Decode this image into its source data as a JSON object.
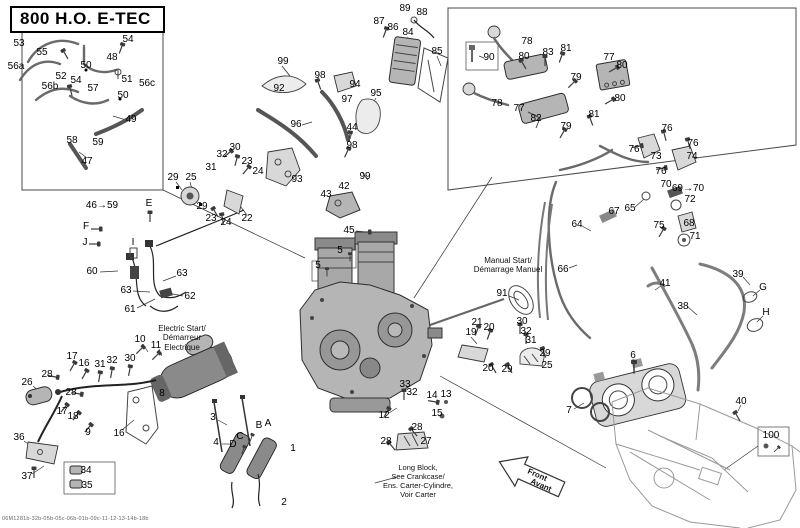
{
  "title": "800 H.O. E-TEC",
  "footer_code": "06M1281b-32b-05b-05c-06b-01b-09c-11-12-13-14b-18b",
  "annotations": {
    "electric_start": [
      "Electric Start/",
      "Démarreur",
      "Electrique"
    ],
    "manual_start": [
      "Manual Start/",
      "Démarrage Manuel"
    ],
    "long_block": [
      "Long Block,",
      "See Crankcase/",
      "Ens. Carter-Cylindre,",
      "Voir Carter"
    ],
    "front_arrow": [
      "Front",
      "Avant"
    ]
  },
  "callouts": [
    {
      "t": "53",
      "x": 19,
      "y": 44
    },
    {
      "t": "54",
      "x": 128,
      "y": 40
    },
    {
      "t": "55",
      "x": 42,
      "y": 53
    },
    {
      "t": "56a",
      "x": 16,
      "y": 67
    },
    {
      "t": "48",
      "x": 112,
      "y": 58
    },
    {
      "t": "50",
      "x": 86,
      "y": 66
    },
    {
      "t": "52",
      "x": 61,
      "y": 77
    },
    {
      "t": "54",
      "x": 76,
      "y": 81
    },
    {
      "t": "56b",
      "x": 50,
      "y": 87
    },
    {
      "t": "51",
      "x": 127,
      "y": 80
    },
    {
      "t": "56c",
      "x": 147,
      "y": 84
    },
    {
      "t": "57",
      "x": 93,
      "y": 89
    },
    {
      "t": "50",
      "x": 123,
      "y": 96
    },
    {
      "t": "49",
      "x": 131,
      "y": 120
    },
    {
      "t": "58",
      "x": 72,
      "y": 141
    },
    {
      "t": "59",
      "x": 98,
      "y": 143
    },
    {
      "t": "47",
      "x": 87,
      "y": 162
    },
    {
      "t": "29",
      "x": 173,
      "y": 178
    },
    {
      "t": "25",
      "x": 191,
      "y": 178
    },
    {
      "t": "46→59",
      "x": 102,
      "y": 206
    },
    {
      "t": "E",
      "x": 149,
      "y": 204
    },
    {
      "t": "F",
      "x": 86,
      "y": 227
    },
    {
      "t": "J",
      "x": 85,
      "y": 243
    },
    {
      "t": "I",
      "x": 133,
      "y": 243
    },
    {
      "t": "60",
      "x": 92,
      "y": 272
    },
    {
      "t": "63",
      "x": 182,
      "y": 274
    },
    {
      "t": "63",
      "x": 126,
      "y": 291
    },
    {
      "t": "62",
      "x": 190,
      "y": 297
    },
    {
      "t": "61",
      "x": 130,
      "y": 310
    },
    {
      "t": "30",
      "x": 235,
      "y": 148
    },
    {
      "t": "32",
      "x": 222,
      "y": 155
    },
    {
      "t": "23",
      "x": 247,
      "y": 162
    },
    {
      "t": "31",
      "x": 211,
      "y": 168
    },
    {
      "t": "24",
      "x": 258,
      "y": 172
    },
    {
      "t": "29",
      "x": 202,
      "y": 207
    },
    {
      "t": "23",
      "x": 211,
      "y": 219
    },
    {
      "t": "24",
      "x": 226,
      "y": 223
    },
    {
      "t": "22",
      "x": 247,
      "y": 219
    },
    {
      "t": "99",
      "x": 283,
      "y": 62
    },
    {
      "t": "92",
      "x": 279,
      "y": 89
    },
    {
      "t": "98",
      "x": 320,
      "y": 76
    },
    {
      "t": "94",
      "x": 355,
      "y": 85
    },
    {
      "t": "97",
      "x": 347,
      "y": 100
    },
    {
      "t": "95",
      "x": 376,
      "y": 94
    },
    {
      "t": "96",
      "x": 296,
      "y": 125
    },
    {
      "t": "44",
      "x": 352,
      "y": 128
    },
    {
      "t": "98",
      "x": 352,
      "y": 146
    },
    {
      "t": "99",
      "x": 365,
      "y": 177
    },
    {
      "t": "93",
      "x": 297,
      "y": 180
    },
    {
      "t": "42",
      "x": 344,
      "y": 187
    },
    {
      "t": "43",
      "x": 326,
      "y": 195
    },
    {
      "t": "45",
      "x": 349,
      "y": 231
    },
    {
      "t": "89",
      "x": 405,
      "y": 9
    },
    {
      "t": "88",
      "x": 422,
      "y": 13
    },
    {
      "t": "87",
      "x": 379,
      "y": 22
    },
    {
      "t": "86",
      "x": 393,
      "y": 28
    },
    {
      "t": "84",
      "x": 408,
      "y": 33
    },
    {
      "t": "85",
      "x": 437,
      "y": 52
    },
    {
      "t": "78",
      "x": 527,
      "y": 42
    },
    {
      "t": "90",
      "x": 489,
      "y": 58
    },
    {
      "t": "80",
      "x": 524,
      "y": 57
    },
    {
      "t": "83",
      "x": 548,
      "y": 53
    },
    {
      "t": "81",
      "x": 566,
      "y": 49
    },
    {
      "t": "77",
      "x": 609,
      "y": 58
    },
    {
      "t": "80",
      "x": 622,
      "y": 66
    },
    {
      "t": "79",
      "x": 576,
      "y": 78
    },
    {
      "t": "80",
      "x": 620,
      "y": 99
    },
    {
      "t": "78",
      "x": 497,
      "y": 104
    },
    {
      "t": "77",
      "x": 519,
      "y": 109
    },
    {
      "t": "82",
      "x": 536,
      "y": 119
    },
    {
      "t": "81",
      "x": 594,
      "y": 115
    },
    {
      "t": "79",
      "x": 566,
      "y": 127
    },
    {
      "t": "76",
      "x": 667,
      "y": 129
    },
    {
      "t": "76",
      "x": 634,
      "y": 150
    },
    {
      "t": "73",
      "x": 656,
      "y": 157
    },
    {
      "t": "76",
      "x": 693,
      "y": 144
    },
    {
      "t": "74",
      "x": 692,
      "y": 157
    },
    {
      "t": "76",
      "x": 661,
      "y": 172
    },
    {
      "t": "70",
      "x": 666,
      "y": 185
    },
    {
      "t": "69→70",
      "x": 688,
      "y": 189
    },
    {
      "t": "72",
      "x": 690,
      "y": 200
    },
    {
      "t": "65",
      "x": 630,
      "y": 209
    },
    {
      "t": "67",
      "x": 614,
      "y": 212
    },
    {
      "t": "64",
      "x": 577,
      "y": 225
    },
    {
      "t": "75",
      "x": 659,
      "y": 226
    },
    {
      "t": "68",
      "x": 689,
      "y": 224
    },
    {
      "t": "71",
      "x": 695,
      "y": 237
    },
    {
      "t": "66",
      "x": 563,
      "y": 270
    },
    {
      "t": "41",
      "x": 665,
      "y": 284
    },
    {
      "t": "38",
      "x": 683,
      "y": 307
    },
    {
      "t": "39",
      "x": 738,
      "y": 275
    },
    {
      "t": "G",
      "x": 763,
      "y": 288
    },
    {
      "t": "H",
      "x": 766,
      "y": 313
    },
    {
      "t": "6",
      "x": 633,
      "y": 356
    },
    {
      "t": "7",
      "x": 569,
      "y": 411
    },
    {
      "t": "40",
      "x": 741,
      "y": 402
    },
    {
      "t": "100",
      "x": 771,
      "y": 436
    },
    {
      "t": "91",
      "x": 502,
      "y": 294
    },
    {
      "t": "21",
      "x": 477,
      "y": 323
    },
    {
      "t": "20",
      "x": 489,
      "y": 328
    },
    {
      "t": "19",
      "x": 471,
      "y": 333
    },
    {
      "t": "30",
      "x": 522,
      "y": 322
    },
    {
      "t": "32",
      "x": 526,
      "y": 332
    },
    {
      "t": "31",
      "x": 531,
      "y": 341
    },
    {
      "t": "29",
      "x": 545,
      "y": 354
    },
    {
      "t": "20",
      "x": 488,
      "y": 369
    },
    {
      "t": "29",
      "x": 507,
      "y": 370
    },
    {
      "t": "25",
      "x": 547,
      "y": 366
    },
    {
      "t": "33",
      "x": 405,
      "y": 385
    },
    {
      "t": "32",
      "x": 412,
      "y": 393
    },
    {
      "t": "14",
      "x": 432,
      "y": 396
    },
    {
      "t": "13",
      "x": 446,
      "y": 395
    },
    {
      "t": "12",
      "x": 384,
      "y": 416
    },
    {
      "t": "15",
      "x": 437,
      "y": 414
    },
    {
      "t": "28",
      "x": 417,
      "y": 428
    },
    {
      "t": "28",
      "x": 386,
      "y": 442
    },
    {
      "t": "27",
      "x": 426,
      "y": 442
    },
    {
      "t": "5",
      "x": 340,
      "y": 251
    },
    {
      "t": "5",
      "x": 318,
      "y": 266
    },
    {
      "t": "10",
      "x": 140,
      "y": 340
    },
    {
      "t": "11",
      "x": 156,
      "y": 346
    },
    {
      "t": "17",
      "x": 72,
      "y": 357
    },
    {
      "t": "16",
      "x": 84,
      "y": 364
    },
    {
      "t": "31",
      "x": 100,
      "y": 365
    },
    {
      "t": "32",
      "x": 112,
      "y": 361
    },
    {
      "t": "30",
      "x": 130,
      "y": 359
    },
    {
      "t": "28",
      "x": 47,
      "y": 375
    },
    {
      "t": "26",
      "x": 27,
      "y": 383
    },
    {
      "t": "28",
      "x": 71,
      "y": 393
    },
    {
      "t": "17",
      "x": 62,
      "y": 412
    },
    {
      "t": "18",
      "x": 73,
      "y": 417
    },
    {
      "t": "9",
      "x": 88,
      "y": 433
    },
    {
      "t": "16",
      "x": 119,
      "y": 434
    },
    {
      "t": "8",
      "x": 162,
      "y": 394
    },
    {
      "t": "36",
      "x": 19,
      "y": 438
    },
    {
      "t": "37",
      "x": 27,
      "y": 477
    },
    {
      "t": "34",
      "x": 86,
      "y": 471
    },
    {
      "t": "35",
      "x": 87,
      "y": 486
    },
    {
      "t": "3",
      "x": 213,
      "y": 418
    },
    {
      "t": "4",
      "x": 216,
      "y": 443
    },
    {
      "t": "B",
      "x": 259,
      "y": 426
    },
    {
      "t": "A",
      "x": 268,
      "y": 424
    },
    {
      "t": "C",
      "x": 240,
      "y": 437
    },
    {
      "t": "D",
      "x": 233,
      "y": 445
    },
    {
      "t": "1",
      "x": 293,
      "y": 449
    },
    {
      "t": "2",
      "x": 284,
      "y": 503
    }
  ],
  "leader_lines": [
    [
      163,
      190,
      305,
      258
    ],
    [
      492,
      177,
      414,
      298
    ],
    [
      440,
      376,
      606,
      468
    ],
    [
      758,
      446,
      724,
      470
    ],
    [
      100,
      272,
      118,
      271
    ],
    [
      183,
      296,
      168,
      293
    ],
    [
      137,
      308,
      155,
      299
    ],
    [
      176,
      276,
      163,
      281
    ],
    [
      133,
      291,
      150,
      292
    ],
    [
      166,
      394,
      178,
      383
    ],
    [
      122,
      430,
      134,
      420
    ],
    [
      33,
      386,
      41,
      393
    ],
    [
      24,
      441,
      34,
      448
    ],
    [
      32,
      474,
      44,
      466
    ],
    [
      143,
      344,
      148,
      352
    ],
    [
      159,
      349,
      162,
      356
    ],
    [
      218,
      420,
      227,
      425
    ],
    [
      222,
      444,
      231,
      444
    ],
    [
      509,
      296,
      519,
      300
    ],
    [
      541,
      363,
      533,
      361
    ],
    [
      471,
      337,
      477,
      344
    ],
    [
      421,
      441,
      412,
      441
    ],
    [
      389,
      413,
      397,
      408
    ],
    [
      408,
      37,
      404,
      47
    ],
    [
      437,
      56,
      441,
      66
    ],
    [
      484,
      58,
      479,
      56
    ],
    [
      574,
      409,
      584,
      403
    ],
    [
      633,
      359,
      634,
      366
    ],
    [
      741,
      405,
      738,
      411
    ],
    [
      687,
      306,
      697,
      315
    ],
    [
      743,
      277,
      750,
      285
    ],
    [
      661,
      286,
      655,
      290
    ],
    [
      760,
      290,
      753,
      296
    ],
    [
      763,
      316,
      757,
      322
    ],
    [
      582,
      226,
      591,
      231
    ],
    [
      635,
      207,
      644,
      199
    ],
    [
      569,
      268,
      577,
      265
    ],
    [
      297,
      176,
      289,
      168
    ],
    [
      302,
      125,
      312,
      122
    ],
    [
      352,
      132,
      350,
      139
    ],
    [
      376,
      98,
      372,
      105
    ],
    [
      247,
      215,
      240,
      206
    ],
    [
      190,
      182,
      192,
      189
    ],
    [
      176,
      182,
      182,
      190
    ],
    [
      356,
      231,
      366,
      232
    ],
    [
      397,
      477,
      375,
      483
    ],
    [
      87,
      158,
      79,
      152
    ],
    [
      126,
      120,
      113,
      116
    ]
  ]
}
